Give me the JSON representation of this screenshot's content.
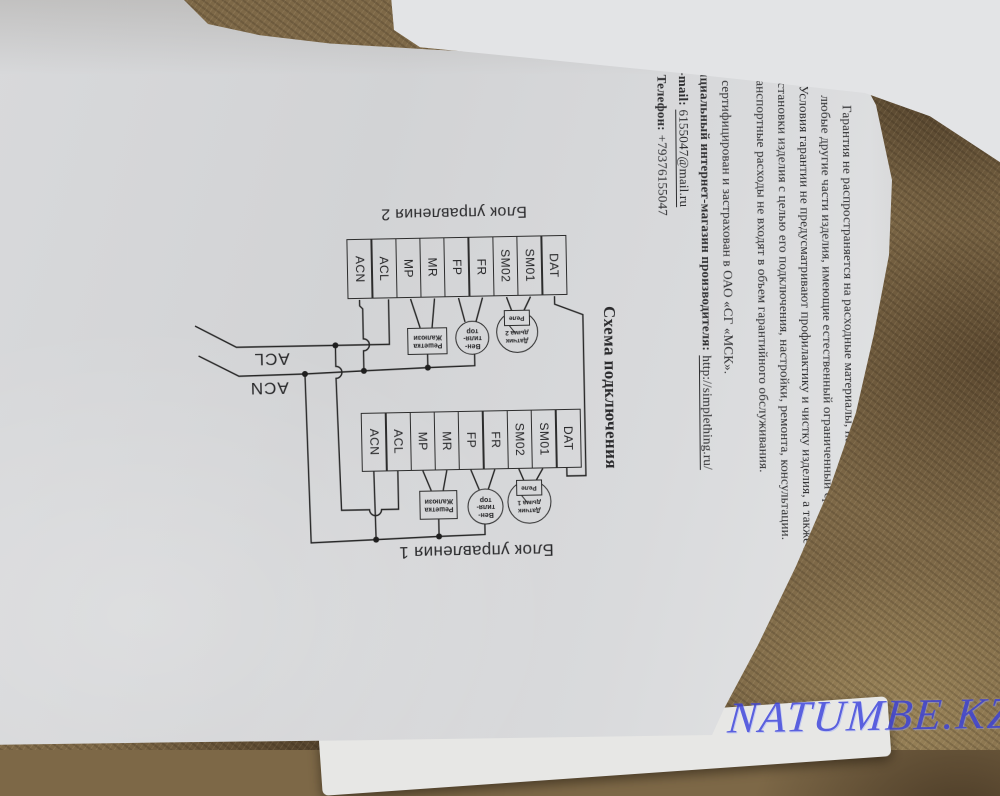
{
  "watermark": {
    "text": "NATUMBE.KZ"
  },
  "page": {
    "warranty": {
      "lines": [
        "Гарантия не распространяется на расходные материалы, навесное оборудование, сменные насадки, а также",
        "любые другие части изделия, имеющие естественный ограниченный срок службы.",
        "Условия гарантии не предусматривают профилактику и чистку изделия, а также выезд мастера к месту",
        "установки изделия с целью его подключения, настройки, ремонта, консультации.",
        "Транспортные расходы не входят в объем гарантийного обслуживания.",
        "Товар сертифицирован и застрахован в ОАО «СГ «МСК»."
      ]
    },
    "contacts": {
      "shop_label": "Официальный интернет-магазин производителя:",
      "shop_url": "http://simplething.ru/",
      "email_label": "E-mail:",
      "email_value": "6155047@mail.ru",
      "phone_label": "Телефон:",
      "phone_value": "+79376155047"
    }
  },
  "diagram": {
    "heading": "Схема подключения",
    "mains": {
      "line_label": "ACL",
      "neutral_label": "ACN"
    },
    "blocks": [
      {
        "title": "Блок управления 2",
        "terminals": [
          "ACN",
          "ACL",
          "MP",
          "MR",
          "FP",
          "FR",
          "SM02",
          "SM01",
          "DAT"
        ],
        "grille_label_1": "Решетка",
        "grille_label_2": "Жалюзи",
        "fan_label_1": "Вен-",
        "fan_label_2": "тиля-",
        "fan_label_3": "тор",
        "smoke_label_1": "Датчик",
        "smoke_label_2": "дыма 2",
        "relay_label": "Реле"
      },
      {
        "title": "Блок управления 1",
        "terminals": [
          "ACN",
          "ACL",
          "MP",
          "MR",
          "FP",
          "FR",
          "SM02",
          "SM01",
          "DAT"
        ],
        "grille_label_1": "Решетка",
        "grille_label_2": "Жалюзи",
        "fan_label_1": "Вен-",
        "fan_label_2": "тиля-",
        "fan_label_3": "тор",
        "smoke_label_1": "Датчик",
        "smoke_label_2": "дыма 1",
        "relay_label": "Реле"
      }
    ]
  }
}
